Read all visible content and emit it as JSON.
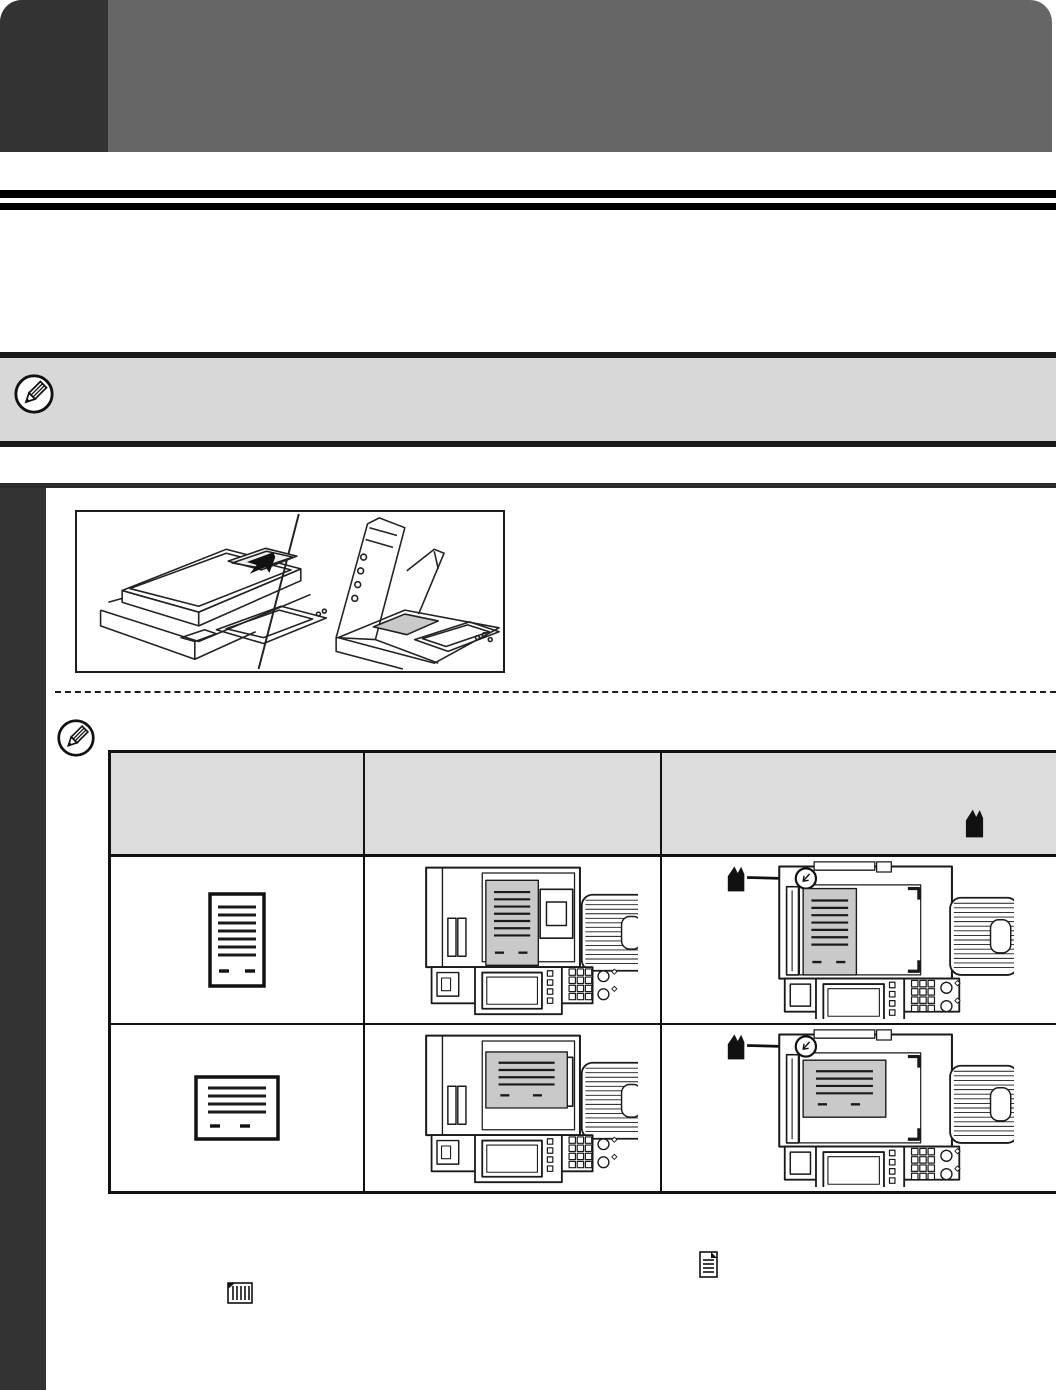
{
  "colors": {
    "header_band": "#666666",
    "header_tab": "#333333",
    "sidebar": "#333333",
    "note_bg": "#d8d8d8",
    "table_header_bg": "#dcdcdc",
    "doc_fill": "#c9c9c9",
    "line": "#1a1a1a"
  },
  "icons": {
    "note_icon": "pencil-icon",
    "header_marker": "corner-alignment-mark-icon",
    "bottom_right_icon": "document-horizontal-lines-icon",
    "bottom_left_icon": "document-vertical-lines-icon"
  },
  "figure": {
    "name": "document-feeder-and-document-glass-illustration",
    "parts": [
      "automatic-document-feeder-view",
      "document-glass-open-view"
    ]
  },
  "table": {
    "columns": [
      "original",
      "document-feeder-placement",
      "document-glass-placement"
    ],
    "rows": [
      {
        "orientation": "portrait"
      },
      {
        "orientation": "landscape"
      }
    ]
  }
}
